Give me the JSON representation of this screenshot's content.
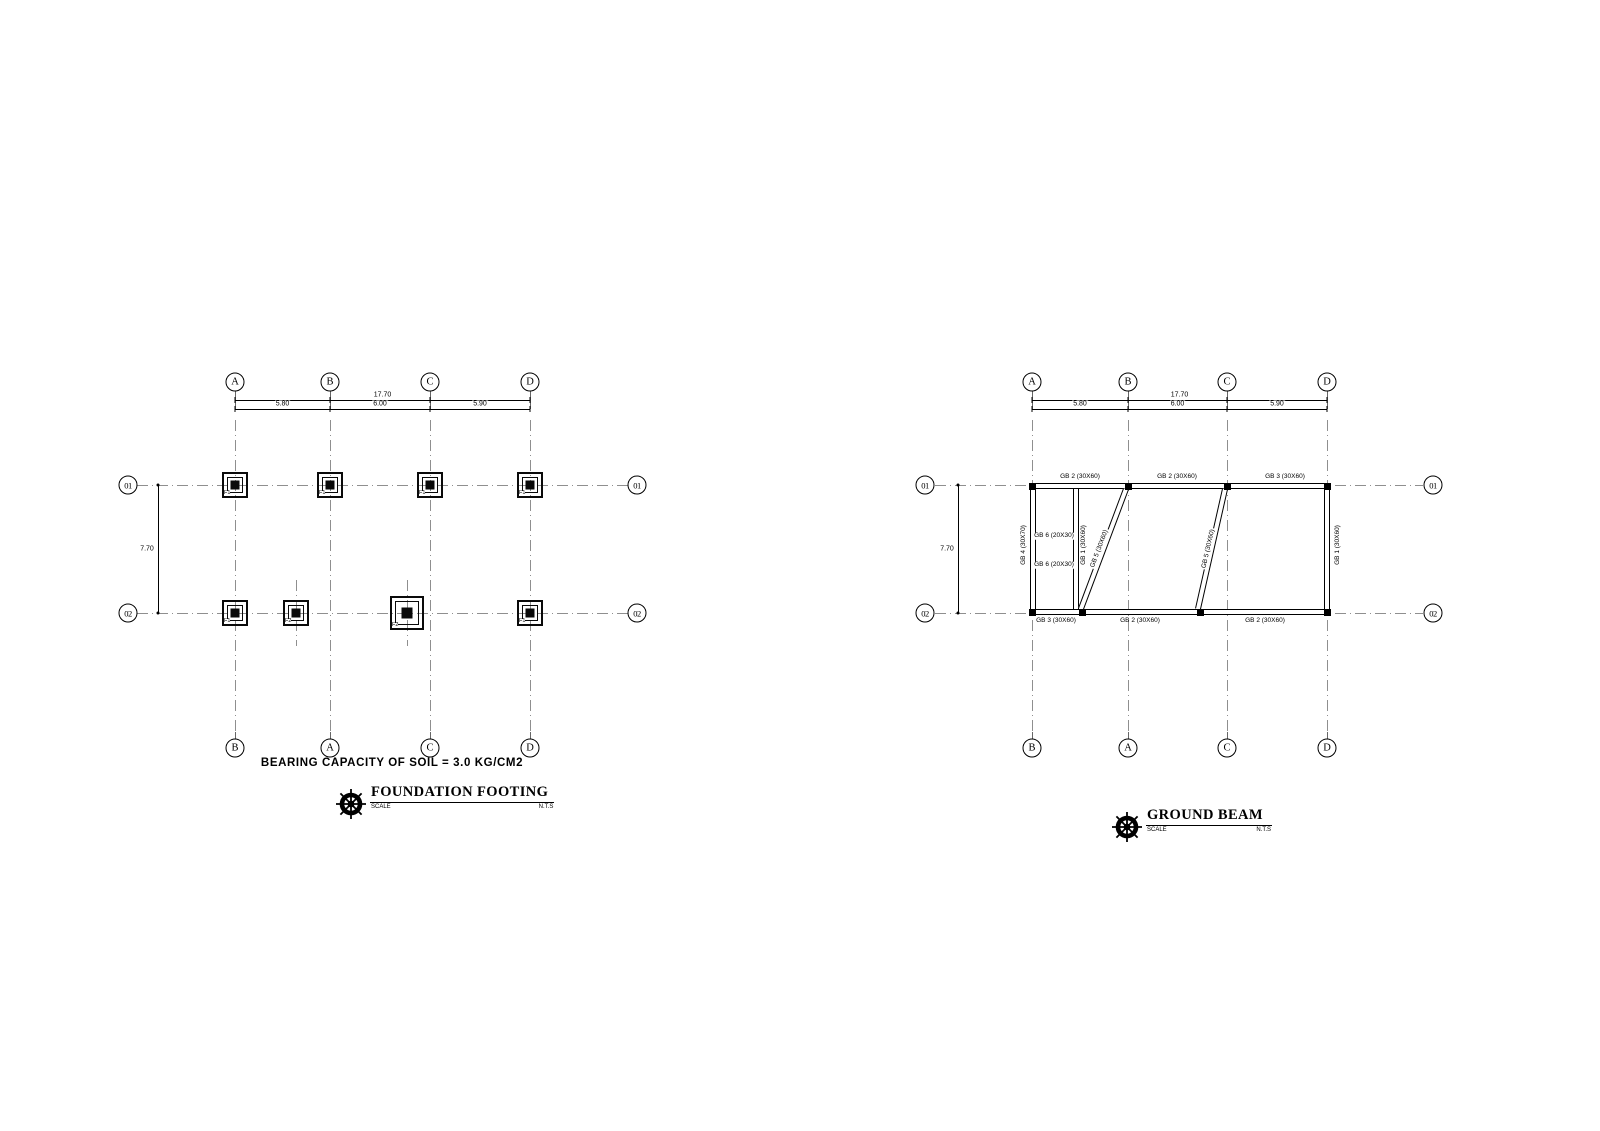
{
  "sheet": {
    "background": "#ffffff",
    "ink": "#000000",
    "grid_color": "#8f8f8f"
  },
  "foundation_plan": {
    "title": "FOUNDATION FOOTING",
    "scale_label": "SCALE",
    "scale_value": "N.T.S",
    "note": "BEARING CAPACITY OF SOIL = 3.0 KG/CM2",
    "dim_overall": "17.70",
    "dim_segments": [
      "5.80",
      "6.00",
      "5.90"
    ],
    "dim_vertical": "7.70",
    "grid_cols": [
      {
        "top": "A",
        "bottom": "B",
        "x": 235
      },
      {
        "top": "B",
        "bottom": "A",
        "x": 330
      },
      {
        "top": "C",
        "bottom": "C",
        "x": 430
      },
      {
        "top": "D",
        "bottom": "D",
        "x": 530
      }
    ],
    "grid_rows": [
      {
        "label": "01",
        "y": 485
      },
      {
        "label": "02",
        "y": 613
      }
    ],
    "footings": [
      {
        "label": "F1",
        "x": 235,
        "y": 485,
        "size": 26
      },
      {
        "label": "F1",
        "x": 330,
        "y": 485,
        "size": 26
      },
      {
        "label": "F1",
        "x": 430,
        "y": 485,
        "size": 26
      },
      {
        "label": "F1",
        "x": 530,
        "y": 485,
        "size": 26
      },
      {
        "label": "F1",
        "x": 235,
        "y": 613,
        "size": 26
      },
      {
        "label": "F2",
        "x": 296,
        "y": 613,
        "size": 26,
        "offset_crosshair": true
      },
      {
        "label": "F2",
        "x": 407,
        "y": 613,
        "size": 34,
        "offset_crosshair": true
      },
      {
        "label": "F1",
        "x": 530,
        "y": 613,
        "size": 26
      }
    ]
  },
  "ground_plan": {
    "title": "GROUND BEAM",
    "scale_label": "SCALE",
    "scale_value": "N.T.S",
    "dim_overall": "17.70",
    "dim_segments": [
      "5.80",
      "6.00",
      "5.90"
    ],
    "dim_vertical": "7.70",
    "grid_cols": [
      {
        "top": "A",
        "bottom": "B",
        "x": 1032
      },
      {
        "top": "B",
        "bottom": "A",
        "x": 1128
      },
      {
        "top": "C",
        "bottom": "C",
        "x": 1227
      },
      {
        "top": "D",
        "bottom": "D",
        "x": 1327
      }
    ],
    "grid_rows": [
      {
        "label": "01",
        "y": 485
      },
      {
        "label": "02",
        "y": 613
      }
    ],
    "beam_segments_h": [
      {
        "x1": 1030,
        "x2": 1330,
        "y": 486
      },
      {
        "x1": 1030,
        "x2": 1330,
        "y": 612
      },
      {
        "x1": 1036,
        "x2": 1073,
        "y": 536
      },
      {
        "x1": 1036,
        "x2": 1073,
        "y": 565
      }
    ],
    "beam_segments_v": [
      {
        "x": 1033,
        "y1": 483,
        "y2": 615
      },
      {
        "x": 1327,
        "y1": 483,
        "y2": 615
      },
      {
        "x": 1076,
        "y1": 489,
        "y2": 609
      }
    ],
    "beam_segments_d": [
      {
        "x1": 1126,
        "y1": 489,
        "len": 128,
        "angle": 110.6
      },
      {
        "x1": 1225,
        "y1": 489,
        "len": 123,
        "angle": 102.7
      }
    ],
    "joints": [
      [
        1032,
        486
      ],
      [
        1128,
        486
      ],
      [
        1227,
        486
      ],
      [
        1327,
        486
      ],
      [
        1032,
        612
      ],
      [
        1082,
        612
      ],
      [
        1200,
        612
      ],
      [
        1327,
        612
      ]
    ],
    "beam_labels": [
      {
        "text": "GB 2 (30X60)",
        "x": 1080,
        "y": 477
      },
      {
        "text": "GB 2 (30X60)",
        "x": 1177,
        "y": 477
      },
      {
        "text": "GB 3 (30X60)",
        "x": 1285,
        "y": 477
      },
      {
        "text": "GB 3 (30X60)",
        "x": 1056,
        "y": 621
      },
      {
        "text": "GB 2 (30X60)",
        "x": 1140,
        "y": 621
      },
      {
        "text": "GB 2 (30X60)",
        "x": 1265,
        "y": 621
      },
      {
        "text": "GB 4 (30X70)",
        "x": 1024,
        "y": 545,
        "rot": -90
      },
      {
        "text": "GB 1 (30X60)",
        "x": 1084,
        "y": 545,
        "rot": -90
      },
      {
        "text": "GB 1 (30X60)",
        "x": 1338,
        "y": 545,
        "rot": -90
      },
      {
        "text": "GB 6 (20X30)",
        "x": 1054,
        "y": 536,
        "bg": true
      },
      {
        "text": "GB 6 (20X30)",
        "x": 1054,
        "y": 565,
        "bg": true
      },
      {
        "text": "GB 5 (30X60)",
        "x": 1100,
        "y": 549,
        "rot": -69.4,
        "bg": true
      },
      {
        "text": "GB 5 (30X60)",
        "x": 1209,
        "y": 549,
        "rot": -77.3,
        "bg": true
      }
    ]
  }
}
